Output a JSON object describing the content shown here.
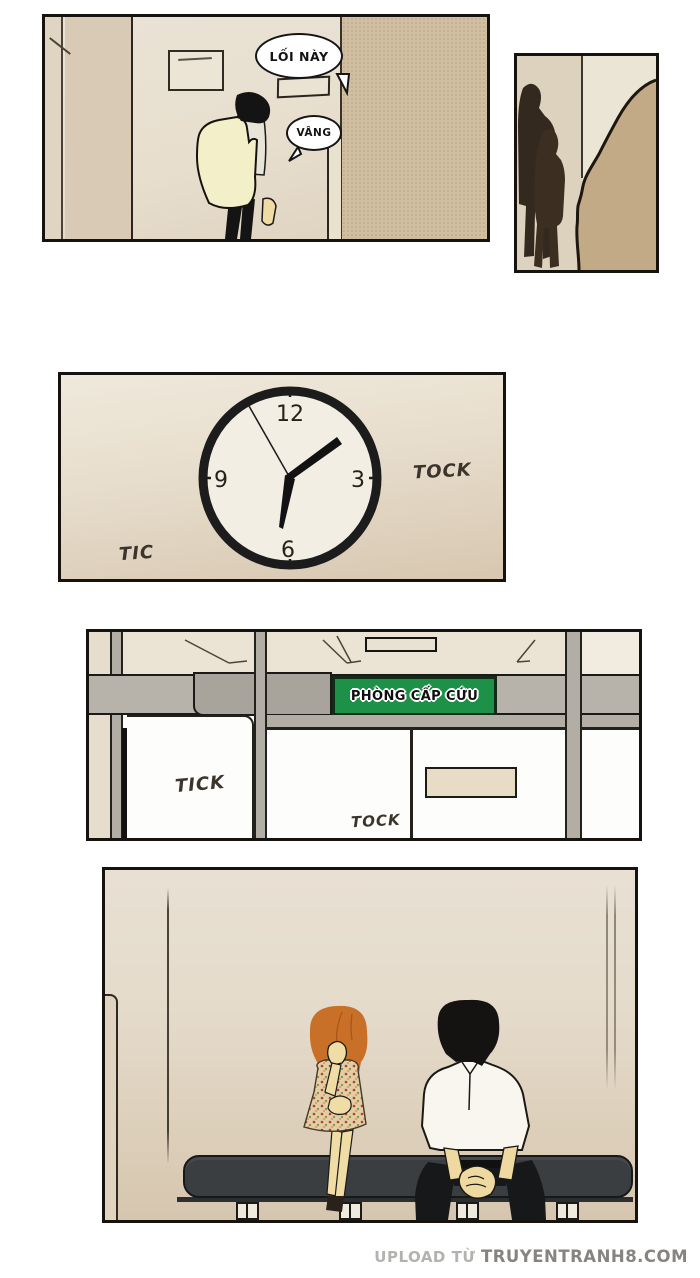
{
  "hallway_panel": {
    "bubbles": [
      {
        "text": "LỐI NÀY"
      },
      {
        "text": "VÂNG"
      }
    ]
  },
  "clock_panel": {
    "numbers": {
      "twelve": "12",
      "three": "3",
      "six": "6",
      "nine": "9"
    },
    "sfx_left": "TIC",
    "sfx_right": "TOCK",
    "hands": {
      "hour": "pointing between 1 and 2",
      "minute": "pointing at 6",
      "second": "pointing just left of 12"
    }
  },
  "er_panel": {
    "sign_label": "PHÒNG CẤP CỨU",
    "sign_color": "#1d9147",
    "sfx_left": "TICK",
    "sfx_center": "TOCK"
  },
  "footer": {
    "prefix": "UPLOAD TỪ",
    "site": "TRUYENTRANH8.COM"
  },
  "colors": {
    "panel_border": "#16130e",
    "sign_green": "#1d9147",
    "bench_dark": "#3b3e41",
    "girl_hair_orange": "#c86f28",
    "coat_cream": "#f3efc9",
    "wall_tan": "#d2bfa2",
    "skin_tone": "#f0dda6"
  }
}
